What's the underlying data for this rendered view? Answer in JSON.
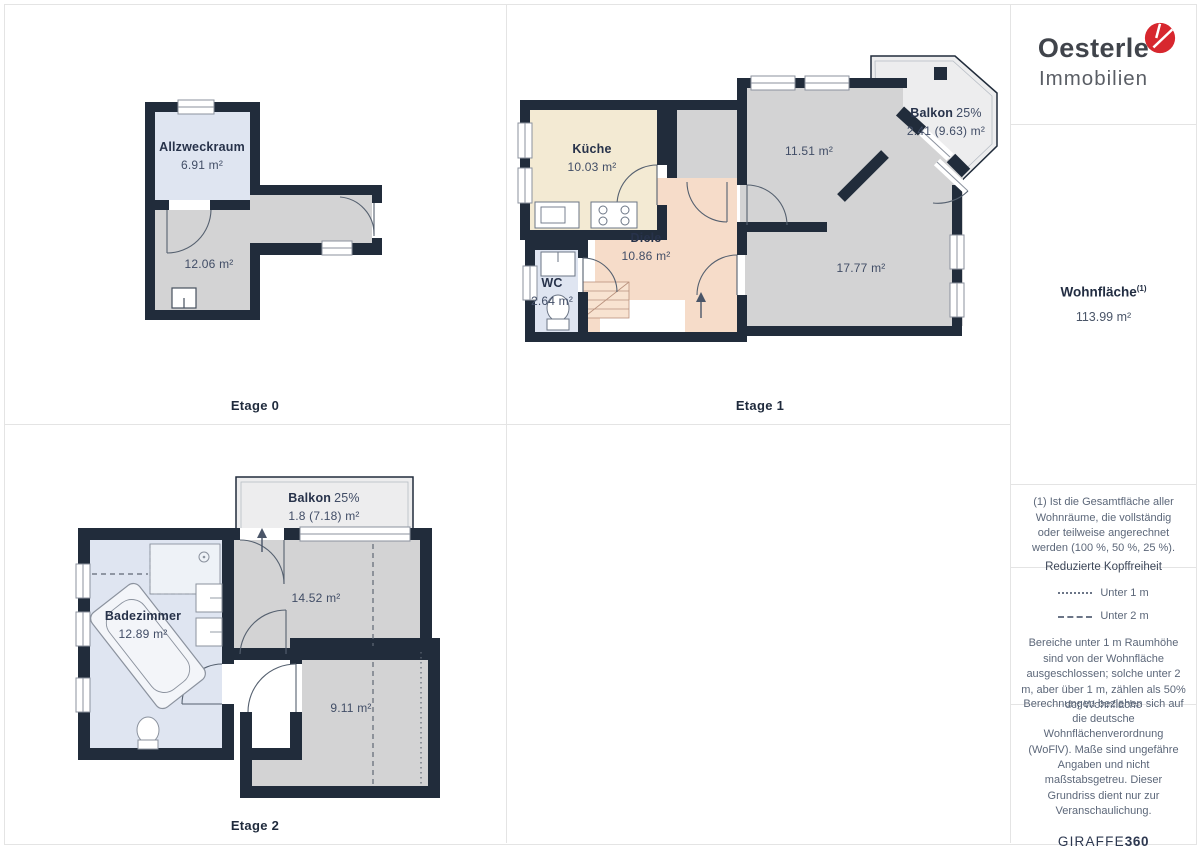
{
  "colors": {
    "wall": "#212c3b",
    "gray": "#d3d3d4",
    "cream": "#f3ead3",
    "salmon": "#f6dcc9",
    "blue": "#dfe5f1",
    "balcony": "#ededee",
    "stairs": "#f8e3d1",
    "red": "#d7272e",
    "textDark": "#27324a",
    "textMuted": "#5c6779"
  },
  "floors": [
    {
      "label": "Etage 0",
      "rooms": [
        {
          "name": "Allzweckraum",
          "area": "6.91 m²"
        },
        {
          "area": "12.06 m²"
        }
      ]
    },
    {
      "label": "Etage 1",
      "rooms": [
        {
          "name": "Küche",
          "area": "10.03 m²"
        },
        {
          "name": "Diele",
          "area": "10.86 m²"
        },
        {
          "name": "WC",
          "area": "2.64 m²"
        },
        {
          "area": "11.51 m²"
        },
        {
          "area": "17.77 m²"
        },
        {
          "name": "Balkon",
          "share": "25%",
          "area": "2.41 (9.63) m²"
        }
      ]
    },
    {
      "label": "Etage 2",
      "rooms": [
        {
          "name": "Balkon",
          "share": "25%",
          "area": "1.8 (7.18) m²"
        },
        {
          "name": "Badezimmer",
          "area": "12.89 m²"
        },
        {
          "area": "14.52 m²"
        },
        {
          "area": "9.11 m²"
        }
      ]
    }
  ],
  "sidebar": {
    "logo": {
      "name": "Oesterle",
      "subtitle": "Immobilien"
    },
    "area": {
      "title": "Wohnfläche",
      "sup": "(1)",
      "value": "113.99 m²"
    },
    "note": "(1) Ist die Gesamtfläche aller Wohnräume, die vollständig oder teilweise angerechnet werden (100 %, 50 %, 25 %).",
    "headroom": {
      "title": "Reduzierte Kopffreiheit",
      "legend": [
        {
          "style": "dotted",
          "label": "Unter 1 m"
        },
        {
          "style": "dashed",
          "label": "Unter 2 m"
        }
      ],
      "text": "Bereiche unter 1 m Raumhöhe sind von der Wohnfläche ausgeschlossen; solche unter 2 m, aber über 1 m, zählen als 50% der Wohnfläche"
    },
    "legal": "Berechnungen beziehen sich auf die deutsche Wohnflächenverordnung (WoFlV). Maße sind ungefähre Angaben und nicht maßstabsgetreu. Dieser Grundriss dient nur zur Veranschaulichung.",
    "brand360": {
      "part1": "GIRAFFE",
      "part2": "360"
    }
  }
}
